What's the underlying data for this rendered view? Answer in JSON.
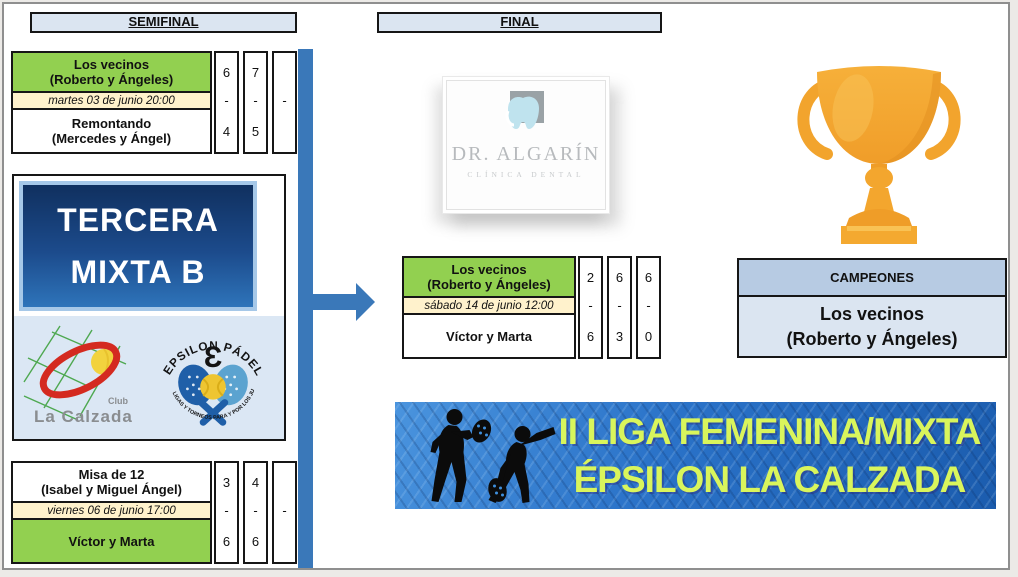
{
  "headers": {
    "semifinal": "SEMIFINAL",
    "final": "FINAL"
  },
  "bracket": {
    "sf1": {
      "team1": {
        "name": "Los vecinos",
        "players": "(Roberto y Ángeles)",
        "sets": [
          "6",
          "7",
          ""
        ]
      },
      "date": "martes 03 de junio 20:00",
      "dashes": [
        "-",
        "-",
        "-"
      ],
      "team2": {
        "name": "Remontando",
        "players": "(Mercedes y Ángel)",
        "sets": [
          "4",
          "5",
          ""
        ]
      }
    },
    "sf2": {
      "team1": {
        "name": "Misa de 12",
        "players": "(Isabel y Miguel Ángel)",
        "sets": [
          "3",
          "4",
          ""
        ]
      },
      "date": "viernes 06 de junio 17:00",
      "dashes": [
        "-",
        "-",
        "-"
      ],
      "team2": {
        "name": "Víctor y Marta",
        "players": "",
        "sets": [
          "6",
          "6",
          ""
        ]
      }
    },
    "final": {
      "team1": {
        "name": "Los vecinos",
        "players": "(Roberto y Ángeles)",
        "sets": [
          "2",
          "6",
          "6"
        ]
      },
      "date": "sábado 14 de junio 12:00",
      "dashes": [
        "-",
        "-",
        "-"
      ],
      "team2": {
        "name": "Víctor y Marta",
        "players": "",
        "sets": [
          "6",
          "3",
          "0"
        ]
      }
    }
  },
  "group": {
    "line1": "TERCERA",
    "line2": "MIXTA B"
  },
  "logos": {
    "la_calzada": {
      "club": "Club",
      "name": "La Calzada"
    },
    "epsilon": {
      "arc_top": "EPSILON PÁDEL",
      "symbol": "Ɛ",
      "arc_bottom": "LIGAS Y TORNEOS PARA Y POR LOS JUGADORES"
    },
    "dental": {
      "name": "DR. ALGARÍN",
      "tagline": "CLÍNICA DENTAL"
    }
  },
  "champions": {
    "header": "CAMPEONES",
    "name": "Los vecinos",
    "players": "(Roberto y Ángeles)"
  },
  "banner": {
    "line1": "II LIGA FEMENINA/MIXTA",
    "line2": "ÉPSILON LA CALZADA"
  },
  "colors": {
    "winner_green": "#92d050",
    "schedule_cream": "#fff2cc",
    "header_blue": "#dbe5f1",
    "champion_header_blue": "#b7cbe3",
    "connector_blue": "#3a78b9",
    "banner_text": "#d9f55c",
    "trophy_gold": "#f3a62e"
  }
}
